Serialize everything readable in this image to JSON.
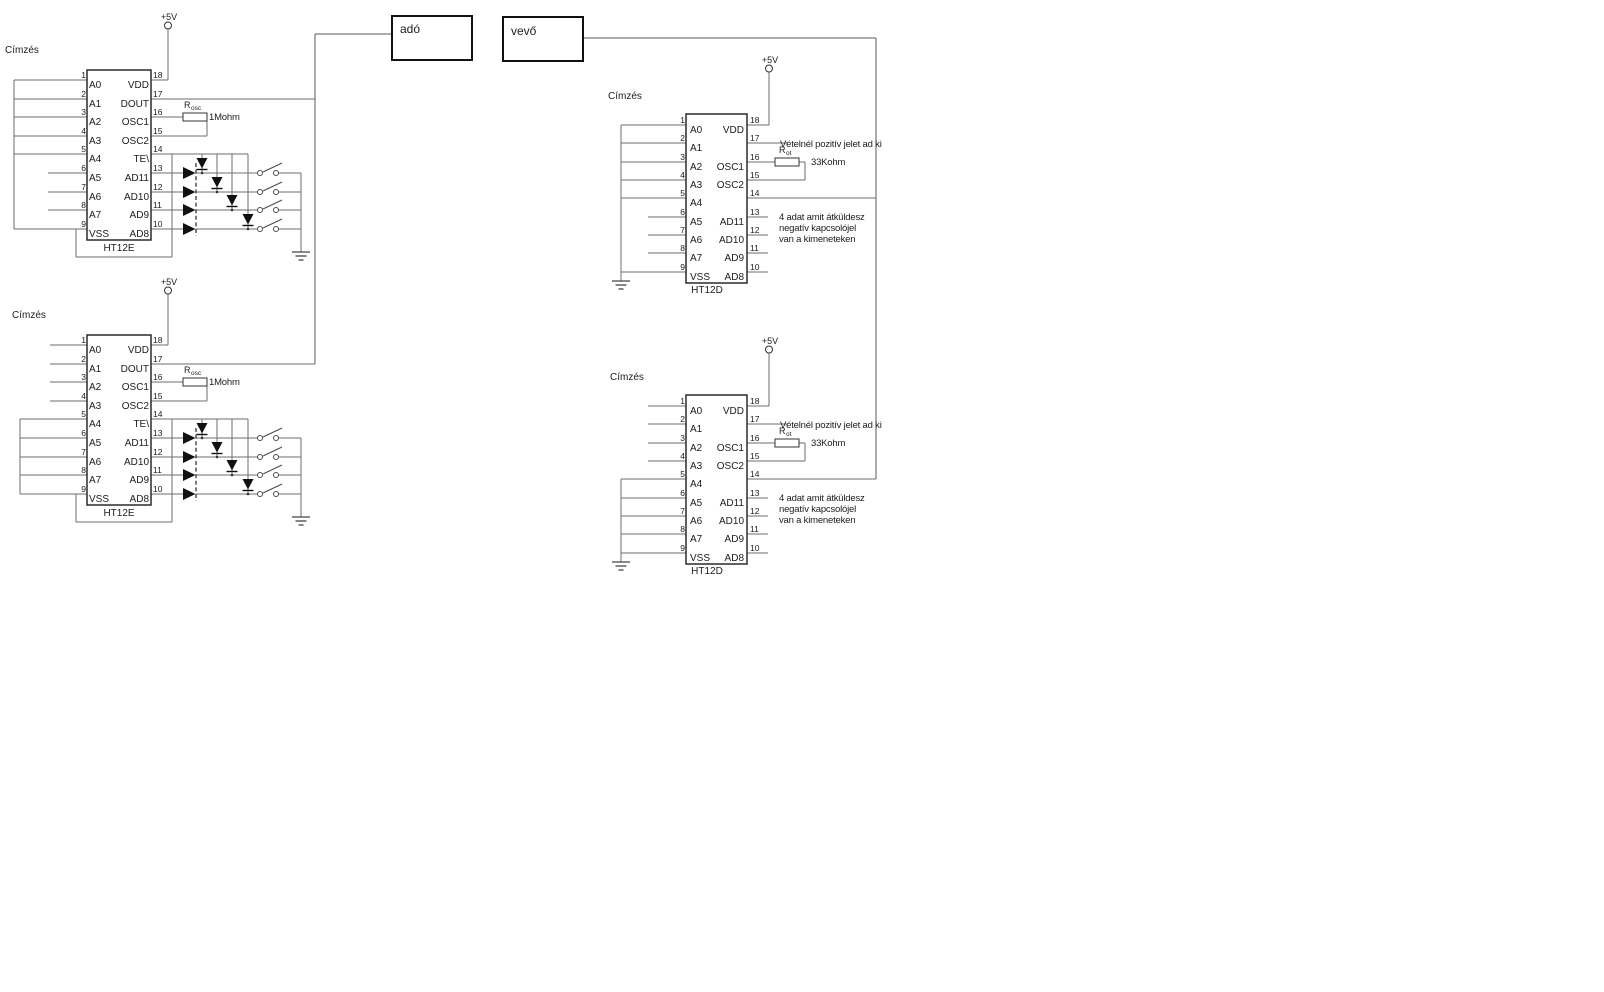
{
  "boxes": {
    "transmitter": "adó",
    "receiver": "vevő"
  },
  "labels": {
    "addressing": "Címzés",
    "power": "+5V"
  },
  "encoder": {
    "chip": "HT12E",
    "left_pins": [
      {
        "n": "1",
        "name": "A0"
      },
      {
        "n": "2",
        "name": "A1"
      },
      {
        "n": "3",
        "name": "A2"
      },
      {
        "n": "4",
        "name": "A3"
      },
      {
        "n": "5",
        "name": "A4"
      },
      {
        "n": "6",
        "name": "A5"
      },
      {
        "n": "7",
        "name": "A6"
      },
      {
        "n": "8",
        "name": "A7"
      },
      {
        "n": "9",
        "name": "VSS"
      }
    ],
    "right_pins": [
      {
        "n": "18",
        "name": "VDD"
      },
      {
        "n": "17",
        "name": "DOUT"
      },
      {
        "n": "16",
        "name": "OSC1"
      },
      {
        "n": "15",
        "name": "OSC2"
      },
      {
        "n": "14",
        "name": "TE\\"
      },
      {
        "n": "13",
        "name": "AD11"
      },
      {
        "n": "12",
        "name": "AD10"
      },
      {
        "n": "11",
        "name": "AD9"
      },
      {
        "n": "10",
        "name": "AD8"
      }
    ],
    "resistor": {
      "prefix": "R",
      "sub": "osc",
      "value": "1Mohm"
    }
  },
  "decoder": {
    "chip": "HT12D",
    "left_pins": [
      {
        "n": "1",
        "name": "A0"
      },
      {
        "n": "2",
        "name": "A1"
      },
      {
        "n": "3",
        "name": "A2"
      },
      {
        "n": "4",
        "name": "A3"
      },
      {
        "n": "5",
        "name": "A4"
      },
      {
        "n": "6",
        "name": "A5"
      },
      {
        "n": "7",
        "name": "A6"
      },
      {
        "n": "8",
        "name": "A7"
      },
      {
        "n": "9",
        "name": "VSS"
      }
    ],
    "right_pins": [
      {
        "n": "18",
        "name": "VDD"
      },
      {
        "n": "17",
        "name": ""
      },
      {
        "n": "16",
        "name": "OSC1"
      },
      {
        "n": "15",
        "name": "OSC2"
      },
      {
        "n": "14",
        "name": ""
      },
      {
        "n": "13",
        "name": "AD11"
      },
      {
        "n": "12",
        "name": "AD10"
      },
      {
        "n": "11",
        "name": "AD9"
      },
      {
        "n": "10",
        "name": "AD8"
      }
    ],
    "resistor": {
      "prefix": "R",
      "sub": "ot",
      "value": "33Kohm"
    },
    "output_note": "Vételnél pozitív jelet ad ki",
    "data_note": [
      "4 adat amit átküldesz",
      "negatív kapcsolójel",
      "van a kimeneteken"
    ]
  },
  "colors": {
    "wire": "#6e6e6e",
    "ink": "#1c1c1c",
    "background": "#ffffff"
  }
}
